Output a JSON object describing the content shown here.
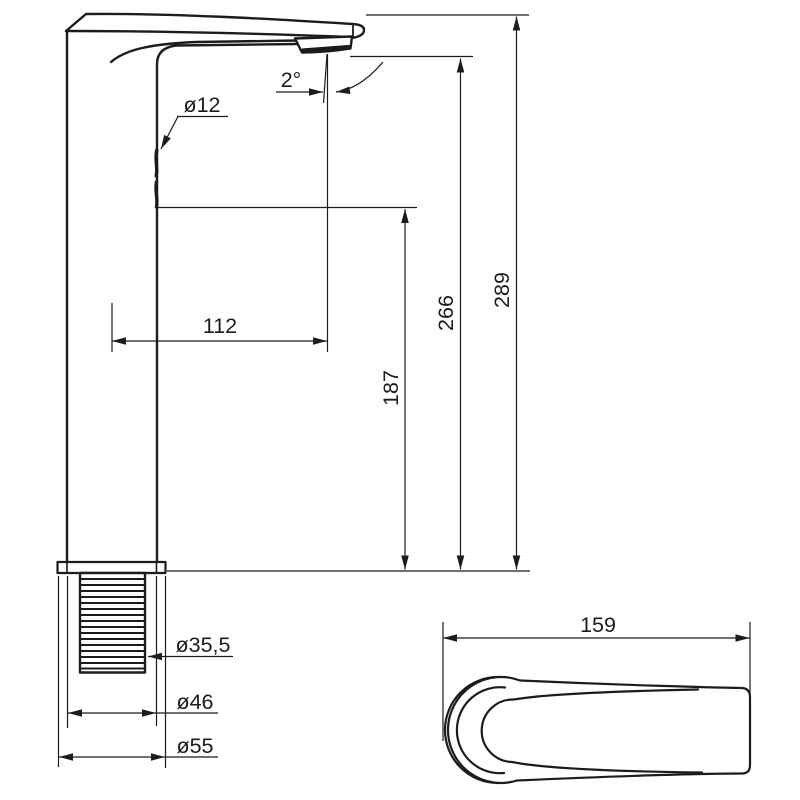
{
  "drawing": {
    "title": "Tall single-lever basin mixer faucet - dimensional technical drawing",
    "views": {
      "side_view": "faucet side elevation with mounting shank",
      "top_view": "lever handle plan view"
    },
    "background": "#ffffff",
    "line_color": "#1c1c1c",
    "dims": {
      "spout_pipe_diameter": "ø12",
      "spout_angle": "2°",
      "spout_reach": "112",
      "spout_underside_height": "187",
      "outlet_height": "266",
      "total_height": "289",
      "shank_diameter": "ø35,5",
      "body_diameter": "ø46",
      "base_diameter": "ø55",
      "handle_length": "159"
    }
  }
}
